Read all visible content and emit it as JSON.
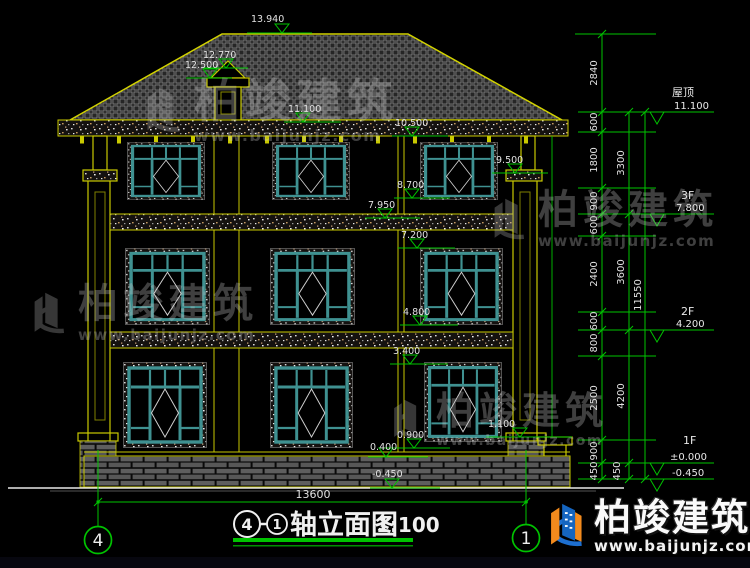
{
  "watermark": {
    "brand": "柏竣建筑",
    "url": "www.baijunjz.com"
  },
  "logo": {
    "brand": "柏竣建筑",
    "url": "www.baijunjz.com"
  },
  "spot_elevations": [
    "13.940",
    "12.770",
    "12.500",
    "11.100",
    "10.500",
    "9.500",
    "8.700",
    "7.950",
    "7.200",
    "4.800",
    "3.400",
    "0.900",
    "1.100",
    "0.400",
    "-0.450"
  ],
  "floor_levels": [
    {
      "label": "屋顶",
      "value": "11.100"
    },
    {
      "label": "3F",
      "value": "7.800"
    },
    {
      "label": "2F",
      "value": "4.200"
    },
    {
      "label": "1F",
      "value": "±0.000"
    },
    {
      "label": "",
      "value": "-0.450"
    }
  ],
  "dim_chain_inner": [
    "2840",
    "600",
    "1800",
    "900",
    "600",
    "2400",
    "600",
    "800",
    "2500",
    "900",
    "450"
  ],
  "dim_chain_mid": [
    "3300",
    "3600",
    "4200",
    "450"
  ],
  "dim_chain_outer": [
    "11550"
  ],
  "bottom_dim": "13600",
  "axis_bubbles": {
    "left": "4",
    "right": "1"
  },
  "title_block": {
    "axis_from": "4",
    "axis_to": "1",
    "title": "轴立面图",
    "scale": "1:100"
  },
  "colors": {
    "cad_yellow": "#c9c900",
    "cad_green": "#00c300",
    "window_teal": "#3f9191",
    "dim_text": "#e2e2e2"
  }
}
